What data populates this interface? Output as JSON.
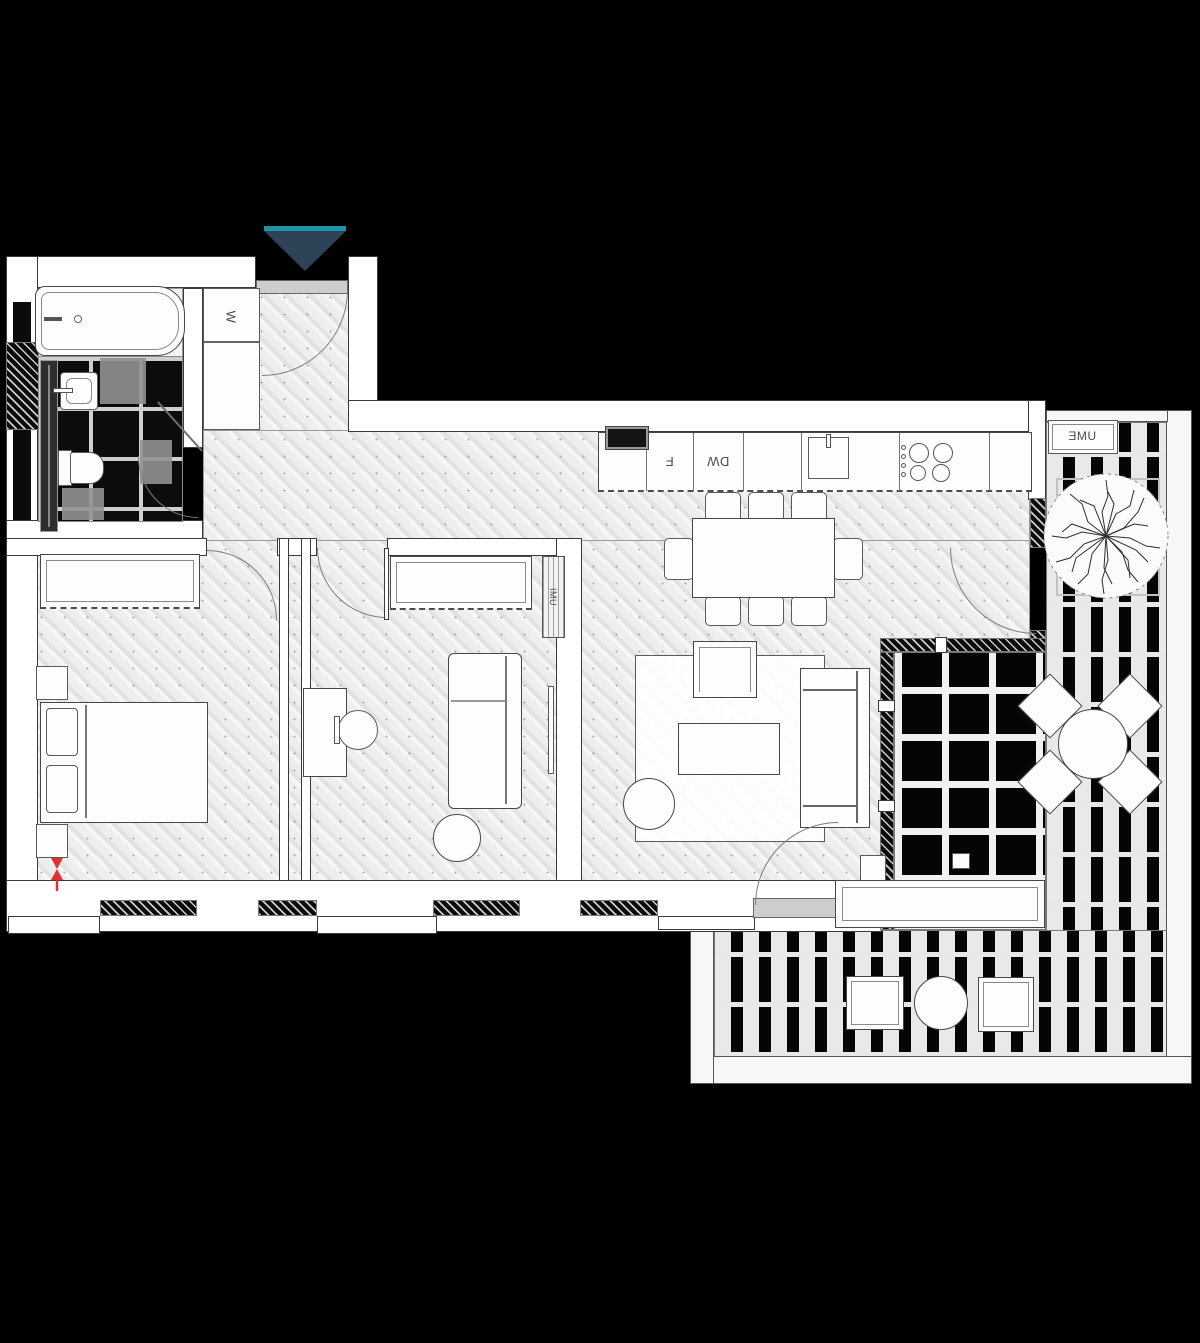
{
  "meta": {
    "drawing_type": "apartment floor plan with terrace"
  },
  "labels": {
    "closet": "W",
    "fridge": "F",
    "dishwasher": "DW",
    "outdoor_unit": "UME",
    "duct_unit": "IMU"
  },
  "colors": {
    "background": "#000000",
    "wall_fill": "#ffffff",
    "outline": "#3a3a3a",
    "parquet_floor": "#ebebeb",
    "entry_marker_fill": "#2e4355",
    "entry_marker_accent": "#1e93a6",
    "alert_symbol": "#e03131"
  }
}
